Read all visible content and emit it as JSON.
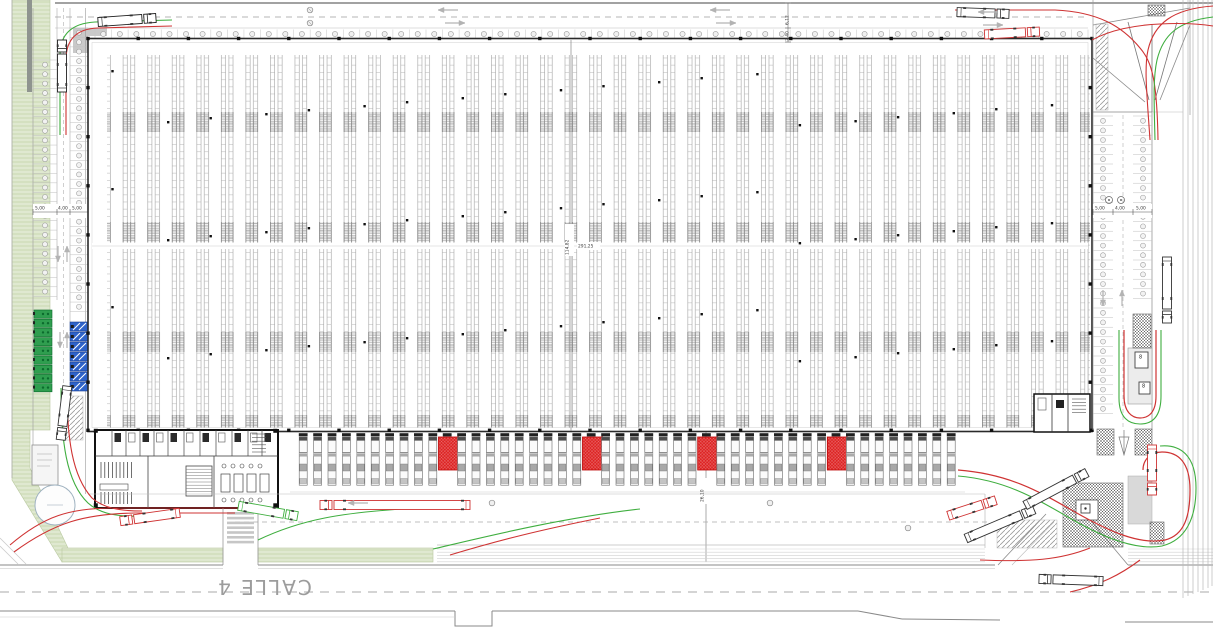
{
  "labels": {
    "street": "CALLE 4",
    "dim_left": [
      "5,00",
      "4,00",
      "5,00"
    ],
    "dim_right": [
      "5,00",
      "4,00",
      "5,00"
    ],
    "building_length": "291,25",
    "building_width": "114,82",
    "yard_dim": "26,10",
    "top_road_width": "6,12",
    "top_road_verge": "2,40",
    "sign8": "8"
  },
  "colors": {
    "paper": "#ffffff",
    "line_dark": "#2a2a2a",
    "line_mid": "#8f8f8f",
    "line_light": "#c9c9c9",
    "green_area": "#dfe8d0",
    "green_area_line": "#c2d3a4",
    "stall_green": "#2f9e4f",
    "stall_green_dark": "#0c6b2e",
    "stall_blue": "#2f63c9",
    "stall_blue_dark": "#1b3f8f",
    "dock_red": "#dd2222",
    "path_red": "#cf3333",
    "path_green": "#3fae3f",
    "gray_fill": "#c9c9c9"
  },
  "plan": {
    "racking_rows": 40,
    "dock_slots": 46,
    "red_dock_indices": [
      10,
      20,
      28,
      37
    ],
    "top_tree_cells": 60,
    "left_stall_rows": 25,
    "left_stall_rows_inner": 30,
    "right_stall_rows_outer": 31,
    "right_stall_rows_inner": 19,
    "green_stall_count": 9,
    "blue_stall_count": 7
  }
}
